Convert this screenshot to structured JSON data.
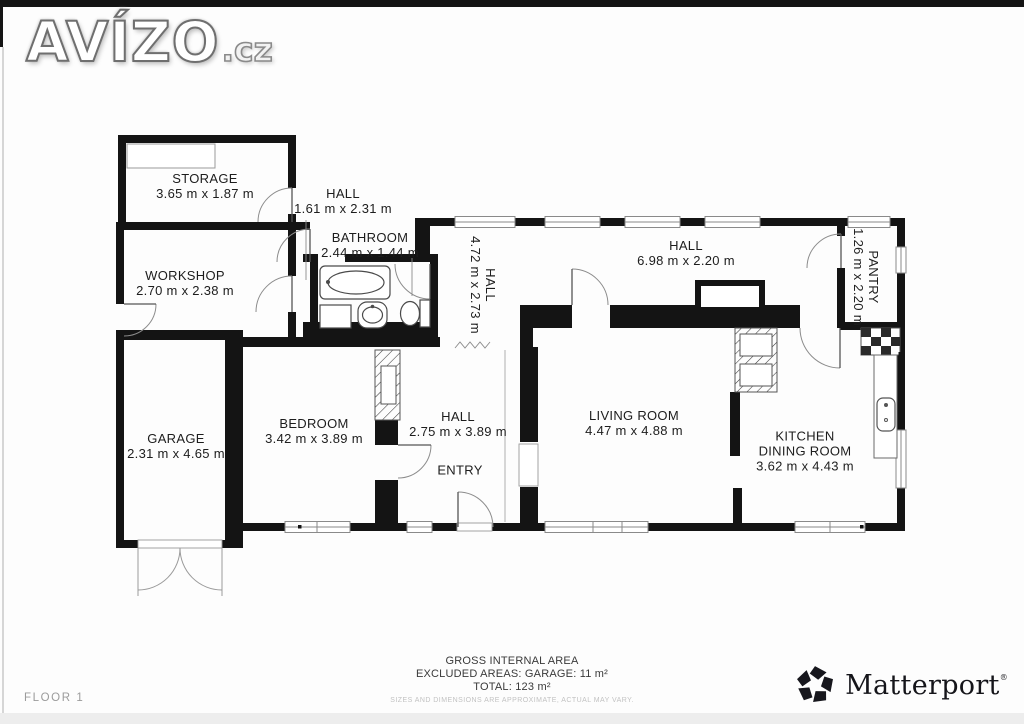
{
  "logo": {
    "text": "AVÍZO",
    "suffix": ".cz"
  },
  "floor_label": "FLOOR 1",
  "footer": {
    "line1": "GROSS INTERNAL AREA",
    "line2": "EXCLUDED AREAS: GARAGE: 11 m²",
    "line3": "TOTAL: 123 m²",
    "disclaimer": "SIZES AND DIMENSIONS ARE APPROXIMATE, ACTUAL MAY VARY."
  },
  "brand": {
    "name": "Matterport",
    "mark": "®"
  },
  "colors": {
    "wall": "#141414",
    "label": "#1d1d1d",
    "muted": "#9b9b9b",
    "disclaimer": "#c2c2c2"
  },
  "floor_plan": {
    "rooms": [
      {
        "id": "storage",
        "lines": [
          "STORAGE",
          "3.65 m x 1.87 m"
        ],
        "x": 205,
        "y": 186
      },
      {
        "id": "hall-top",
        "lines": [
          "HALL",
          "1.61 m x 2.31 m"
        ],
        "x": 343,
        "y": 201
      },
      {
        "id": "bathroom",
        "lines": [
          "BATHROOM",
          "2.44 m x 1.44 m"
        ],
        "x": 370,
        "y": 245
      },
      {
        "id": "workshop",
        "lines": [
          "WORKSHOP",
          "2.70 m x 2.38 m"
        ],
        "x": 185,
        "y": 283
      },
      {
        "id": "hall-vert",
        "lines": [
          "HALL",
          "4.72 m x 2.73 m"
        ],
        "vertical": true,
        "x": 483,
        "y": 285
      },
      {
        "id": "hall-long",
        "lines": [
          "HALL",
          "6.98 m x 2.20 m"
        ],
        "x": 686,
        "y": 253
      },
      {
        "id": "pantry",
        "lines": [
          "PANTRY",
          "1.26 m x 2.20 m"
        ],
        "vertical": true,
        "x": 866,
        "y": 277
      },
      {
        "id": "garage",
        "lines": [
          "GARAGE",
          "2.31 m x 4.65 m"
        ],
        "x": 176,
        "y": 446
      },
      {
        "id": "bedroom",
        "lines": [
          "BEDROOM",
          "3.42 m x 3.89 m"
        ],
        "x": 314,
        "y": 431
      },
      {
        "id": "hall-entry",
        "lines": [
          "HALL",
          "2.75 m x 3.89 m"
        ],
        "x": 458,
        "y": 424
      },
      {
        "id": "entry",
        "lines": [
          "ENTRY"
        ],
        "x": 460,
        "y": 470
      },
      {
        "id": "living-room",
        "lines": [
          "LIVING ROOM",
          "4.47 m x 4.88 m"
        ],
        "x": 634,
        "y": 423
      },
      {
        "id": "kitchen",
        "lines": [
          "KITCHEN",
          "DINING ROOM",
          "3.62 m x 4.43 m"
        ],
        "x": 805,
        "y": 451
      }
    ]
  }
}
